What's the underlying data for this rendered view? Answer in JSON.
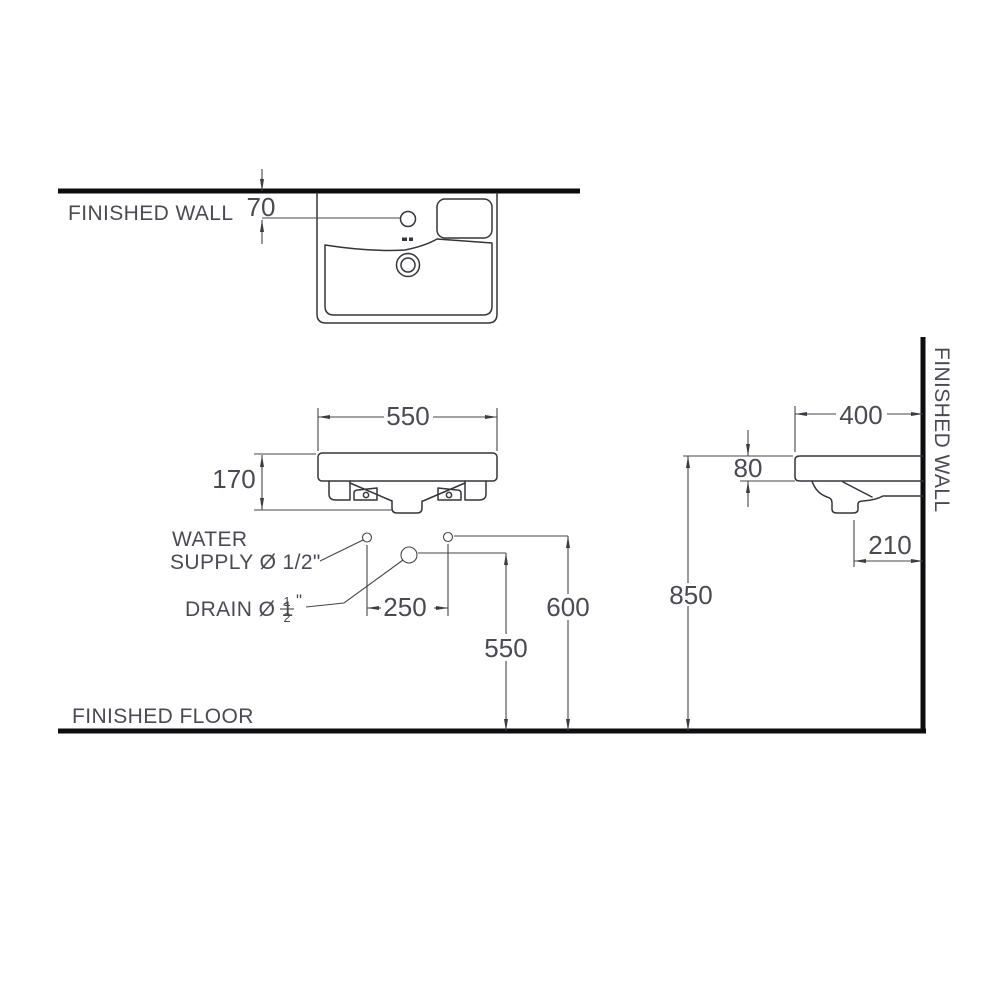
{
  "drawing": {
    "type": "technical-installation-diagram",
    "subject": "wall-hung wash basin with plan, front and side views",
    "labels": {
      "finished_wall_top": "FINISHED WALL",
      "finished_wall_side": "FINISHED WALL",
      "finished_floor": "FINISHED FLOOR",
      "water_supply_line1": "WATER",
      "water_supply_line2": "SUPPLY Ø 1/2\"",
      "drain_prefix": "DRAIN Ø 1",
      "drain_fraction_numerator": "1",
      "drain_fraction_denominator": "2",
      "drain_inch_mark": "\""
    },
    "dimensions": {
      "wall_to_faucet_hole": "70",
      "basin_width": "550",
      "basin_front_height": "170",
      "supply_hole_spacing": "250",
      "drain_height_from_floor": "550",
      "supply_height_from_floor": "600",
      "rim_height_from_floor": "850",
      "basin_depth": "400",
      "rim_thickness": "80",
      "trap_offset_from_wall": "210"
    },
    "colors": {
      "line": "#45454d",
      "outline": "#34343b",
      "heavy_line": "#0d0d0f",
      "text": "#4a4a55",
      "background": "#ffffff"
    }
  }
}
